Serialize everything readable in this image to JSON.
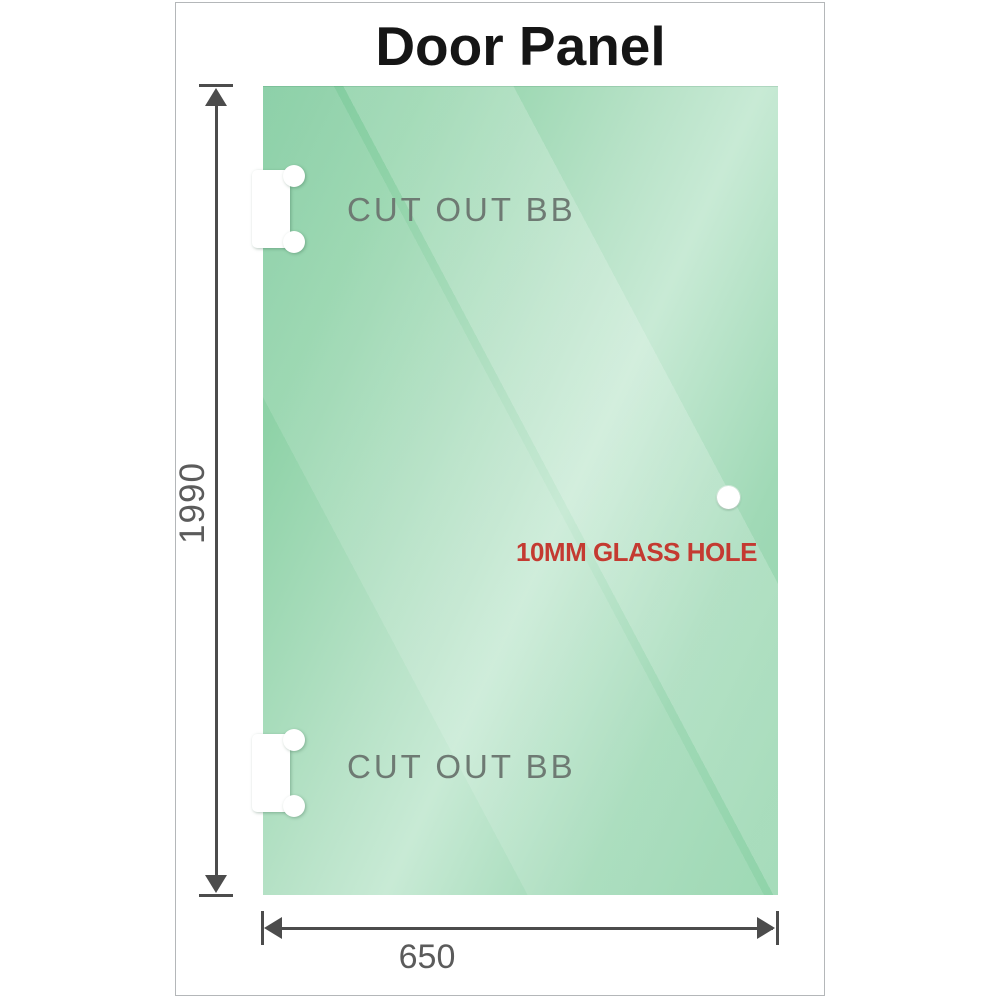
{
  "title": "Door Panel",
  "panel": {
    "cutout_top_label": "CUT OUT BB",
    "cutout_bottom_label": "CUT OUT BB",
    "glass_hole_label": "10MM GLASS HOLE"
  },
  "dimensions": {
    "height_label": "1990",
    "width_label": "650"
  },
  "colors": {
    "glass_green_dark": "#7cc99c",
    "glass_green_light": "#c8ead5",
    "frame_border": "#b4b7b9",
    "dimension_line": "#4c4c4c",
    "dimension_text": "#5b5b5b",
    "cutout_label_text": "#6e7a73",
    "hole_label_text": "#c43a31",
    "title_text": "#151515",
    "cutout_fill": "#ffffff"
  }
}
